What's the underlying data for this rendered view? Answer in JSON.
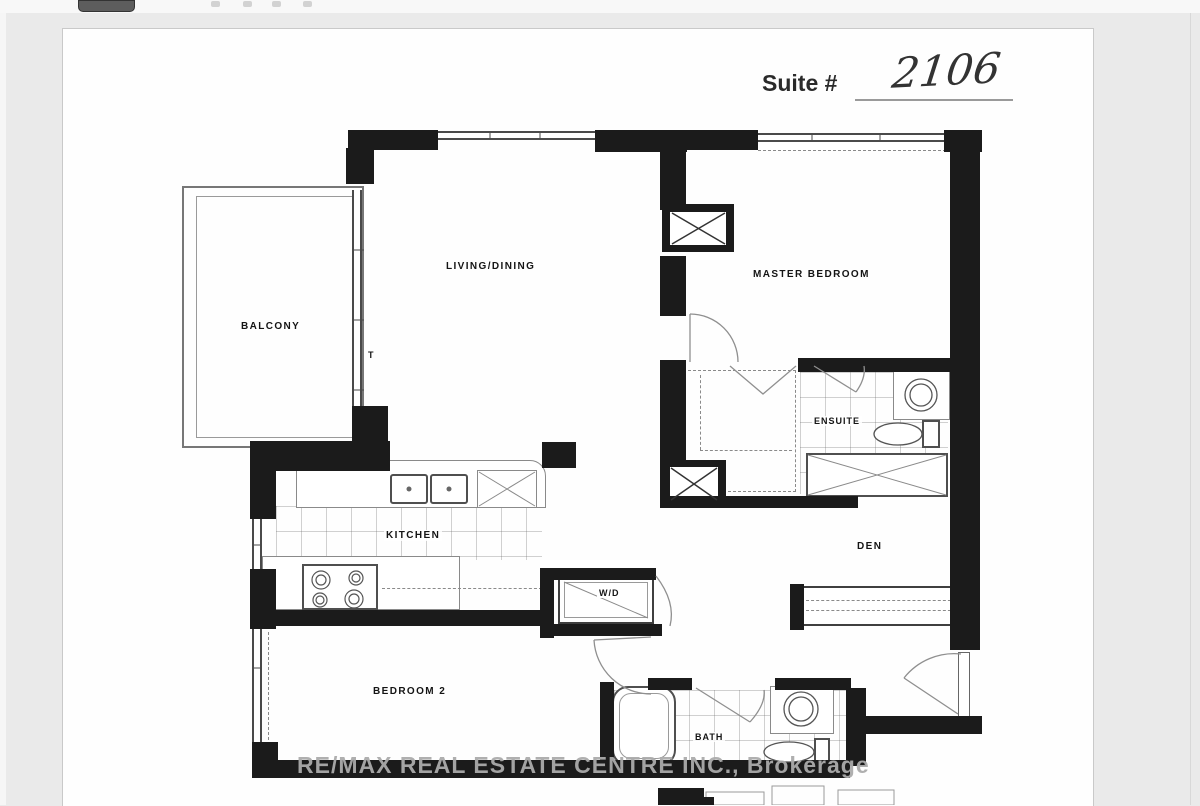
{
  "header": {
    "suite_label": "Suite #",
    "suite_number": "2106"
  },
  "floorplan": {
    "labels": {
      "living_dining": "LIVING/DINING",
      "balcony": "BALCONY",
      "master_bedroom": "MASTER BEDROOM",
      "ensuite": "ENSUITE",
      "kitchen": "KITCHEN",
      "den": "DEN",
      "washer_dryer": "W/D",
      "bedroom2": "BEDROOM 2",
      "bath": "BATH",
      "thermostat_mark": "T"
    }
  },
  "watermark": {
    "text": "RE/MAX REAL ESTATE CENTRE INC., Brokerage"
  },
  "colors": {
    "wall": "#1b1b1b",
    "background": "#eaeaea",
    "paper": "#fefefe",
    "watermark_gray": "#ababab"
  }
}
